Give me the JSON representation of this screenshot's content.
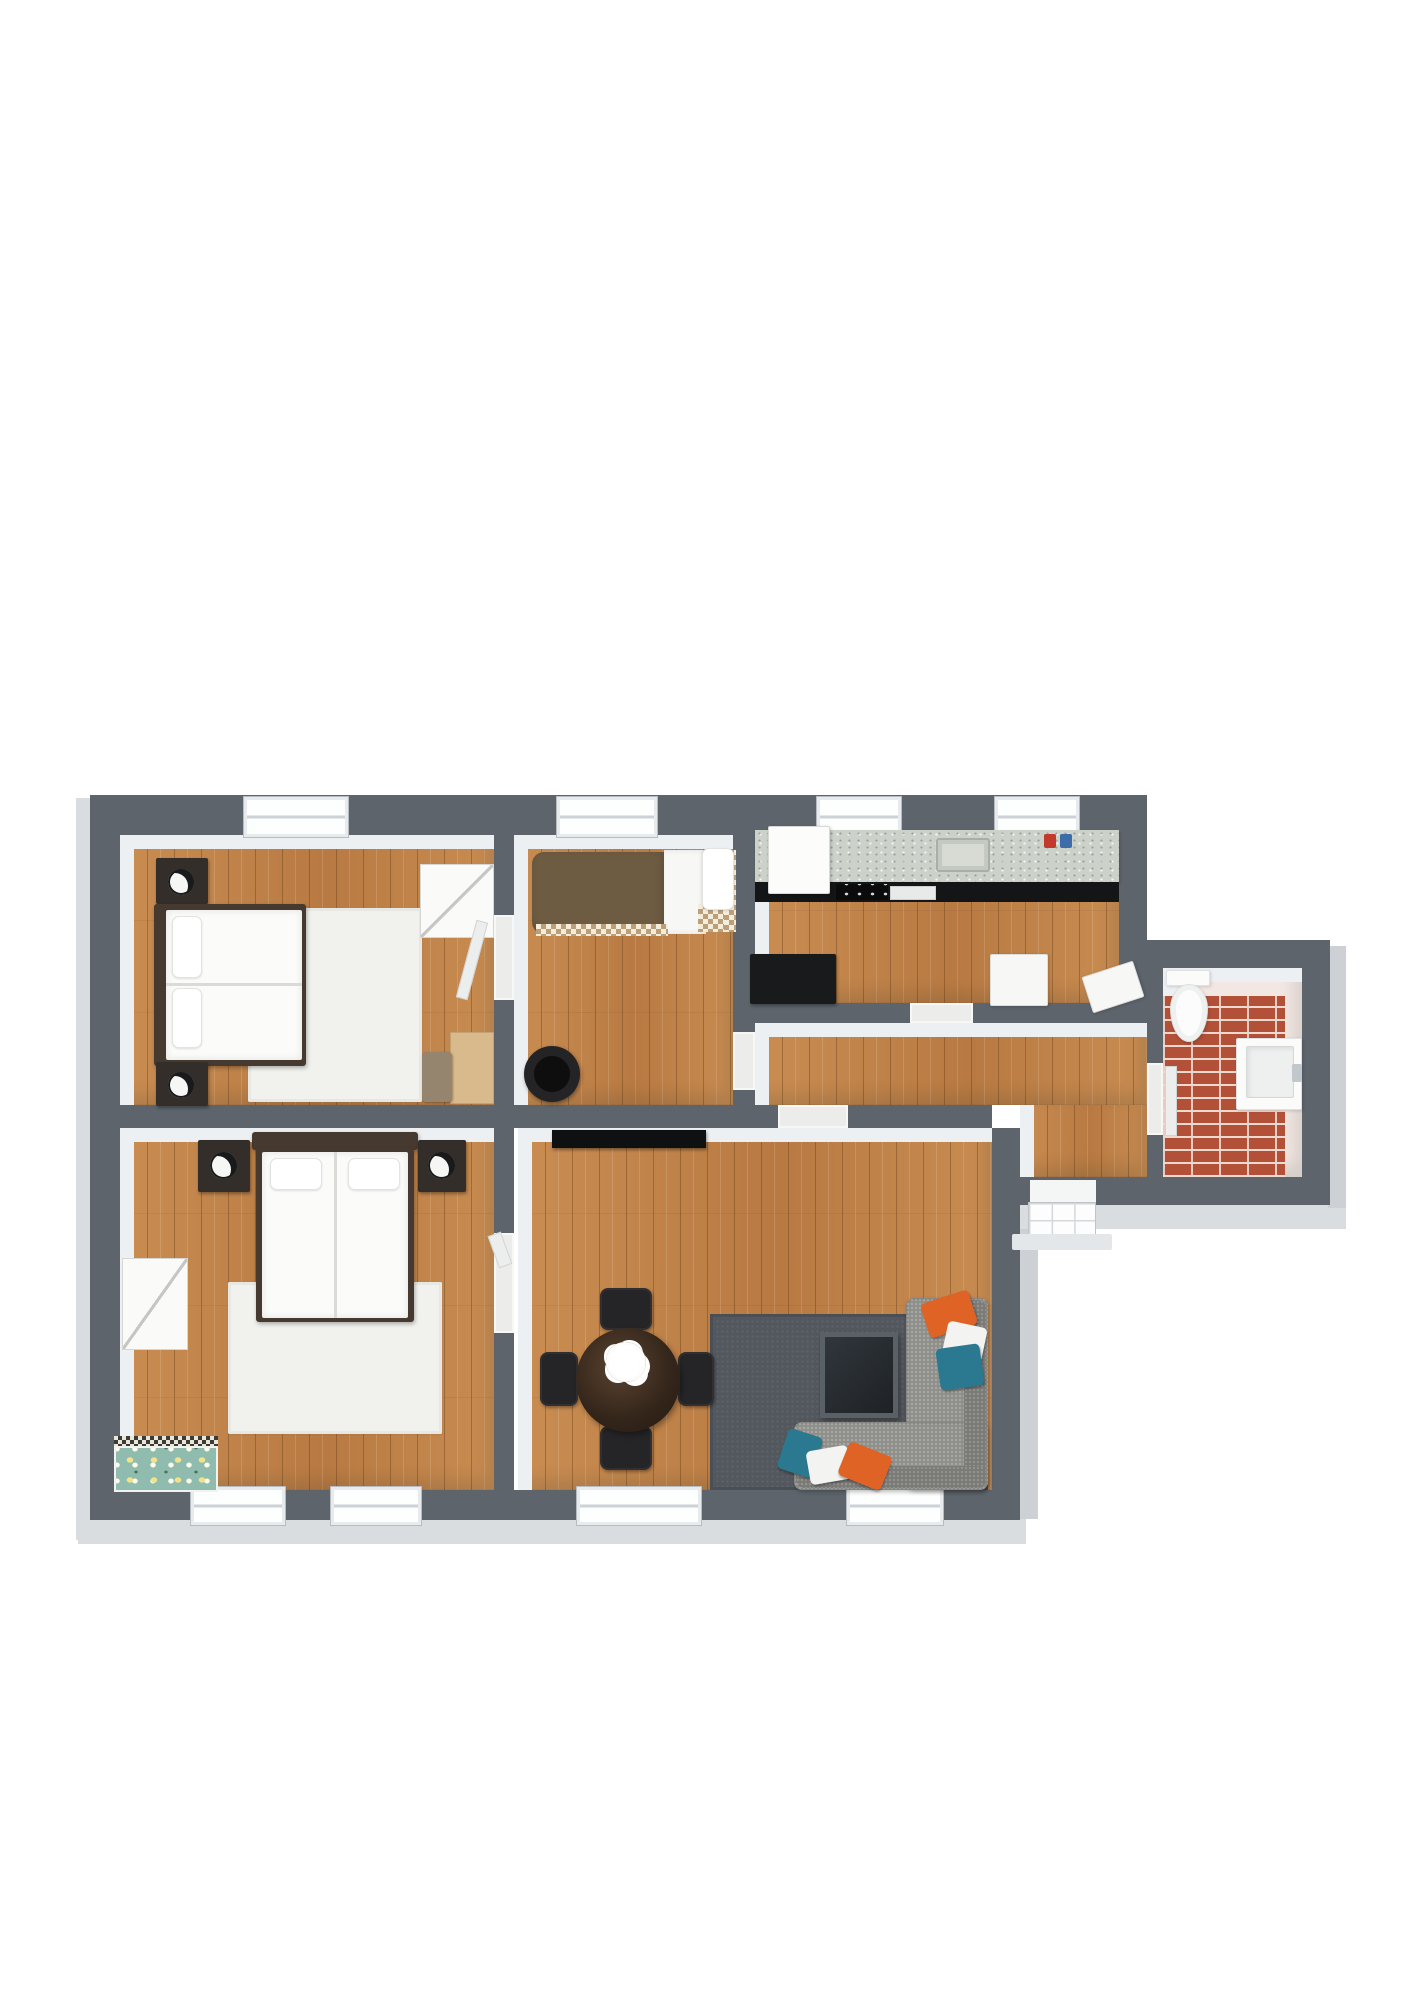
{
  "scene": {
    "width": 1413,
    "height": 2000,
    "background": "#ffffff",
    "description": "3D rendered apartment floor plan, top-down view, no text labels"
  },
  "palette": {
    "wall": "#5d646c",
    "wall_face": "#edf0f2",
    "wood": "#c28349",
    "wood_dark": "#b87a42",
    "rug_light": "#f1f1ee",
    "rug_dark": "#53585e",
    "sofa_gray": "#8e8e8b",
    "pillow_orange": "#e06326",
    "pillow_teal": "#2b7990",
    "brick_red": "#b35138",
    "counter_speckle": "#ccd1ca",
    "cabinet_black": "#141517",
    "jar_red": "#c23a2c",
    "jar_blue": "#3d6da8"
  },
  "layers": {
    "lips": [
      {
        "n": "outer-edge-left",
        "c": "lip",
        "x": 76,
        "y": 798,
        "w": 16,
        "h": 742
      },
      {
        "n": "outer-edge-bottom",
        "c": "lip",
        "x": 78,
        "y": 1516,
        "w": 948,
        "h": 28
      },
      {
        "n": "outer-edge-bottom-right",
        "c": "lip",
        "x": 1014,
        "y": 1205,
        "w": 332,
        "h": 24
      },
      {
        "n": "outer-edge-bath-right",
        "c": "lip2",
        "x": 1328,
        "y": 946,
        "w": 18,
        "h": 262
      },
      {
        "n": "outer-edge-living-right",
        "c": "lip2",
        "x": 1020,
        "y": 1229,
        "w": 18,
        "h": 290
      }
    ],
    "rooms": [
      {
        "n": "room-bedroom-1",
        "c": "wood faces-tl",
        "x": 120,
        "y": 835,
        "w": 374,
        "h": 270
      },
      {
        "n": "room-bedroom-middle",
        "c": "wood faces-tl",
        "x": 514,
        "y": 835,
        "w": 219,
        "h": 270
      },
      {
        "n": "room-kitchen",
        "c": "wood faces-tl",
        "x": 755,
        "y": 835,
        "w": 364,
        "h": 168
      },
      {
        "n": "room-hallway-upper",
        "c": "wood faces-tl",
        "x": 755,
        "y": 1023,
        "w": 392,
        "h": 82
      },
      {
        "n": "room-hallway-entry",
        "c": "wood faces-l",
        "x": 1020,
        "y": 1105,
        "w": 127,
        "h": 72
      },
      {
        "n": "room-living-dining",
        "c": "wood faces-tl",
        "x": 518,
        "y": 1128,
        "w": 474,
        "h": 362
      },
      {
        "n": "room-bedroom-2",
        "c": "wood faces-tl",
        "x": 120,
        "y": 1128,
        "w": 374,
        "h": 362
      },
      {
        "n": "room-bathroom",
        "c": "tile faces-tl",
        "x": 1163,
        "y": 968,
        "w": 139,
        "h": 209
      }
    ],
    "walls": [
      {
        "n": "wall-outer-top",
        "c": "wall",
        "x": 90,
        "y": 795,
        "w": 1057,
        "h": 40
      },
      {
        "n": "wall-outer-left",
        "c": "wall",
        "x": 90,
        "y": 795,
        "w": 30,
        "h": 725
      },
      {
        "n": "wall-outer-bottom",
        "c": "wall",
        "x": 90,
        "y": 1490,
        "w": 930,
        "h": 30
      },
      {
        "n": "wall-living-right",
        "c": "wall",
        "x": 992,
        "y": 1128,
        "w": 28,
        "h": 392
      },
      {
        "n": "wall-kitchen-right",
        "c": "wall",
        "x": 1119,
        "y": 795,
        "w": 28,
        "h": 208
      },
      {
        "n": "wall-bathroom-top",
        "c": "wall",
        "x": 1147,
        "y": 940,
        "w": 183,
        "h": 28
      },
      {
        "n": "wall-bathroom-right",
        "c": "wall",
        "x": 1302,
        "y": 940,
        "w": 28,
        "h": 265
      },
      {
        "n": "wall-bathroom-bottom",
        "c": "wall",
        "x": 1020,
        "y": 1177,
        "w": 310,
        "h": 28
      },
      {
        "n": "wall-divider-left",
        "c": "wall",
        "x": 120,
        "y": 1105,
        "w": 658,
        "h": 23
      },
      {
        "n": "wall-divider-right",
        "c": "wall",
        "x": 848,
        "y": 1105,
        "w": 144,
        "h": 23
      },
      {
        "n": "wall-bed1-middle-upper",
        "c": "wall",
        "x": 494,
        "y": 795,
        "w": 20,
        "h": 120
      },
      {
        "n": "wall-bed1-middle-lower",
        "c": "wall",
        "x": 494,
        "y": 1000,
        "w": 20,
        "h": 105
      },
      {
        "n": "wall-middle-kitchen",
        "c": "wall",
        "x": 733,
        "y": 795,
        "w": 22,
        "h": 237
      },
      {
        "n": "wall-middle-kitchen-stub",
        "c": "wall",
        "x": 733,
        "y": 1090,
        "w": 22,
        "h": 15
      },
      {
        "n": "wall-kitchen-bottom-left",
        "c": "wall",
        "x": 755,
        "y": 1003,
        "w": 155,
        "h": 20
      },
      {
        "n": "wall-kitchen-bottom-right",
        "c": "wall",
        "x": 973,
        "y": 1003,
        "w": 174,
        "h": 20
      },
      {
        "n": "wall-bed2-living-upper",
        "c": "wall",
        "x": 494,
        "y": 1128,
        "w": 20,
        "h": 105
      },
      {
        "n": "wall-bed2-living-lower",
        "c": "wall",
        "x": 494,
        "y": 1333,
        "w": 20,
        "h": 157
      },
      {
        "n": "wall-bathroom-door-upper",
        "c": "wall",
        "x": 1147,
        "y": 968,
        "w": 16,
        "h": 95
      },
      {
        "n": "wall-bathroom-door-lower",
        "c": "wall",
        "x": 1147,
        "y": 1135,
        "w": 16,
        "h": 42
      }
    ],
    "thresholds": [
      {
        "n": "door-bedroom1-middle",
        "c": "thr",
        "x": 494,
        "y": 915,
        "w": 20,
        "h": 85
      },
      {
        "n": "door-middle-hallway",
        "c": "thr",
        "x": 733,
        "y": 1032,
        "w": 22,
        "h": 58
      },
      {
        "n": "door-kitchen-hallway",
        "c": "thr",
        "x": 910,
        "y": 1003,
        "w": 63,
        "h": 20
      },
      {
        "n": "door-living-hallway",
        "c": "thr",
        "x": 778,
        "y": 1105,
        "w": 70,
        "h": 23
      },
      {
        "n": "door-bedroom2-living",
        "c": "thr",
        "x": 494,
        "y": 1233,
        "w": 20,
        "h": 100
      },
      {
        "n": "door-bathroom",
        "c": "thr",
        "x": 1147,
        "y": 1063,
        "w": 16,
        "h": 72
      }
    ],
    "windows": [
      {
        "n": "window-bedroom1",
        "c": "window",
        "x": 243,
        "y": 796,
        "w": 106,
        "h": 42
      },
      {
        "n": "window-middle-room",
        "c": "window",
        "x": 556,
        "y": 796,
        "w": 102,
        "h": 42
      },
      {
        "n": "window-kitchen-1",
        "c": "window",
        "x": 816,
        "y": 796,
        "w": 86,
        "h": 42
      },
      {
        "n": "window-kitchen-2",
        "c": "window",
        "x": 994,
        "y": 796,
        "w": 86,
        "h": 42
      },
      {
        "n": "window-bedroom2-1",
        "c": "window",
        "x": 190,
        "y": 1486,
        "w": 96,
        "h": 40
      },
      {
        "n": "window-bedroom2-2",
        "c": "window",
        "x": 330,
        "y": 1486,
        "w": 92,
        "h": 40
      },
      {
        "n": "window-living-1",
        "c": "window",
        "x": 576,
        "y": 1486,
        "w": 126,
        "h": 40
      },
      {
        "n": "window-living-2",
        "c": "window",
        "x": 846,
        "y": 1486,
        "w": 98,
        "h": 40
      }
    ],
    "furniture": [
      {
        "n": "bedroom1-rug",
        "c": "rug-light",
        "x": 248,
        "y": 908,
        "w": 174,
        "h": 194
      },
      {
        "n": "bedroom1-nightstand-top",
        "c": "nightstand",
        "x": 156,
        "y": 858,
        "w": 52,
        "h": 46
      },
      {
        "n": "bedroom1-lamp-top",
        "c": "lamp",
        "x": 168,
        "y": 869,
        "w": 26,
        "h": 26
      },
      {
        "n": "bedroom1-bed-frame",
        "c": "bedframe",
        "x": 154,
        "y": 904,
        "w": 152,
        "h": 162
      },
      {
        "n": "bedroom1-bed-mattress",
        "c": "mattress",
        "x": 166,
        "y": 910,
        "w": 136,
        "h": 150
      },
      {
        "n": "bedroom1-bed-seam",
        "c": "seam",
        "x": 166,
        "y": 983,
        "w": 136,
        "h": 3
      },
      {
        "n": "bedroom1-pillow-1",
        "c": "pillow",
        "x": 172,
        "y": 916,
        "w": 30,
        "h": 62
      },
      {
        "n": "bedroom1-pillow-2",
        "c": "pillow",
        "x": 172,
        "y": 988,
        "w": 30,
        "h": 60
      },
      {
        "n": "bedroom1-nightstand-bottom",
        "c": "nightstand",
        "x": 156,
        "y": 1062,
        "w": 52,
        "h": 44
      },
      {
        "n": "bedroom1-lamp-bottom",
        "c": "lamp",
        "x": 168,
        "y": 1072,
        "w": 26,
        "h": 26
      },
      {
        "n": "bedroom1-wardrobe",
        "c": "white-case",
        "x": 420,
        "y": 864,
        "w": 74,
        "h": 74
      },
      {
        "n": "bedroom1-desk",
        "c": "desk",
        "x": 450,
        "y": 1032,
        "w": 44,
        "h": 72
      },
      {
        "n": "bedroom1-desk-chair",
        "c": "chair-tan",
        "x": 422,
        "y": 1052,
        "w": 30,
        "h": 50
      },
      {
        "n": "bedroom1-door-leaf",
        "c": "leaf",
        "x": 466,
        "y": 920,
        "w": 12,
        "h": 80,
        "r": 15
      },
      {
        "n": "middle-bed-duvet",
        "c": "duvet",
        "x": 532,
        "y": 852,
        "w": 136,
        "h": 82
      },
      {
        "n": "middle-bed-sheet",
        "c": "sheet",
        "x": 664,
        "y": 850,
        "w": 42,
        "h": 84
      },
      {
        "n": "middle-bed-checker-strip",
        "c": "checker",
        "x": 536,
        "y": 924,
        "w": 132,
        "h": 12
      },
      {
        "n": "middle-bed-checker-corner",
        "c": "checker",
        "x": 698,
        "y": 904,
        "w": 38,
        "h": 28
      },
      {
        "n": "middle-bed-checker-right",
        "c": "checker",
        "x": 724,
        "y": 850,
        "w": 12,
        "h": 82
      },
      {
        "n": "middle-bed-pillow",
        "c": "pillow",
        "x": 702,
        "y": 848,
        "w": 32,
        "h": 62
      },
      {
        "n": "middle-tub-chair",
        "c": "tubchair",
        "x": 524,
        "y": 1046,
        "w": 56,
        "h": 56
      },
      {
        "n": "middle-tub-chair-seat",
        "c": "tubchair-in",
        "x": 534,
        "y": 1056,
        "w": 36,
        "h": 36
      },
      {
        "n": "kitchen-counter",
        "c": "counter",
        "x": 755,
        "y": 830,
        "w": 364,
        "h": 52
      },
      {
        "n": "kitchen-cabinets",
        "c": "cabinets",
        "x": 755,
        "y": 882,
        "w": 364,
        "h": 20
      },
      {
        "n": "kitchen-fridge",
        "c": "appliance-white",
        "x": 768,
        "y": 826,
        "w": 62,
        "h": 68
      },
      {
        "n": "kitchen-stove",
        "c": "stove",
        "x": 836,
        "y": 884,
        "w": 52,
        "h": 16
      },
      {
        "n": "kitchen-dishwasher",
        "c": "dishwasher",
        "x": 890,
        "y": 886,
        "w": 46,
        "h": 14
      },
      {
        "n": "kitchen-sink",
        "c": "sink",
        "x": 936,
        "y": 838,
        "w": 54,
        "h": 34
      },
      {
        "n": "kitchen-jar-red",
        "c": "jar-red",
        "x": 1044,
        "y": 834,
        "w": 12,
        "h": 14
      },
      {
        "n": "kitchen-jar-blue",
        "c": "jar-blue",
        "x": 1060,
        "y": 834,
        "w": 12,
        "h": 14
      },
      {
        "n": "kitchen-table-black",
        "c": "table-black",
        "x": 750,
        "y": 954,
        "w": 86,
        "h": 50
      },
      {
        "n": "kitchen-table-white",
        "c": "table-white",
        "x": 990,
        "y": 954,
        "w": 58,
        "h": 52
      },
      {
        "n": "kitchen-chair-white",
        "c": "table-white",
        "x": 1086,
        "y": 968,
        "w": 54,
        "h": 38,
        "r": -18
      },
      {
        "n": "bathroom-brick-floor",
        "c": "brick",
        "x": 1163,
        "y": 996,
        "w": 122,
        "h": 181
      },
      {
        "n": "bathroom-door-leaf",
        "c": "leaf",
        "x": 1165,
        "y": 1066,
        "w": 12,
        "h": 70
      },
      {
        "n": "toilet-tank",
        "c": "porcelain",
        "x": 1166,
        "y": 970,
        "w": 44,
        "h": 16
      },
      {
        "n": "toilet-bowl",
        "c": "bowl",
        "x": 1170,
        "y": 984,
        "w": 38,
        "h": 58
      },
      {
        "n": "bathroom-vanity",
        "c": "porcelain",
        "x": 1236,
        "y": 1038,
        "w": 66,
        "h": 72
      },
      {
        "n": "bathroom-basin",
        "c": "basin",
        "x": 1246,
        "y": 1046,
        "w": 48,
        "h": 52
      },
      {
        "n": "bathroom-faucet",
        "c": "faucet",
        "x": 1292,
        "y": 1064,
        "w": 10,
        "h": 18
      },
      {
        "n": "living-console",
        "c": "console",
        "x": 552,
        "y": 1130,
        "w": 154,
        "h": 18
      },
      {
        "n": "living-rug",
        "c": "rug-dark",
        "x": 710,
        "y": 1314,
        "w": 278,
        "h": 176
      },
      {
        "n": "living-tv-panel",
        "c": "tv",
        "x": 820,
        "y": 1332,
        "w": 78,
        "h": 86
      },
      {
        "n": "sofa-right-section",
        "c": "sofa",
        "x": 906,
        "y": 1298,
        "w": 82,
        "h": 192
      },
      {
        "n": "sofa-bottom-section",
        "c": "sofa",
        "x": 794,
        "y": 1422,
        "w": 194,
        "h": 68
      },
      {
        "n": "sofa-backrest-right",
        "c": "sofa-back",
        "x": 964,
        "y": 1300,
        "w": 22,
        "h": 188
      },
      {
        "n": "sofa-backrest-bottom",
        "c": "sofa-back",
        "x": 796,
        "y": 1466,
        "w": 190,
        "h": 22
      },
      {
        "n": "sofa-pillow-orange-top",
        "c": "pillow-o",
        "x": 924,
        "y": 1296,
        "w": 50,
        "h": 36,
        "r": -18
      },
      {
        "n": "sofa-pillow-white-top",
        "c": "pillow-w",
        "x": 944,
        "y": 1324,
        "w": 40,
        "h": 42,
        "r": 12
      },
      {
        "n": "sofa-pillow-teal-top",
        "c": "pillow-t",
        "x": 938,
        "y": 1346,
        "w": 44,
        "h": 42,
        "r": -8
      },
      {
        "n": "sofa-pillow-teal-bottom",
        "c": "pillow-t",
        "x": 782,
        "y": 1432,
        "w": 36,
        "h": 42,
        "r": 18
      },
      {
        "n": "sofa-pillow-white-bottom",
        "c": "pillow-w",
        "x": 808,
        "y": 1448,
        "w": 42,
        "h": 34,
        "r": -10
      },
      {
        "n": "sofa-pillow-orange-bottom",
        "c": "pillow-o",
        "x": 842,
        "y": 1448,
        "w": 46,
        "h": 36,
        "r": 22
      },
      {
        "n": "dining-chair-top",
        "c": "chair-dark",
        "x": 600,
        "y": 1288,
        "w": 52,
        "h": 42
      },
      {
        "n": "dining-chair-bottom",
        "c": "chair-dark",
        "x": 600,
        "y": 1426,
        "w": 52,
        "h": 44
      },
      {
        "n": "dining-chair-left",
        "c": "chair-dark",
        "x": 540,
        "y": 1352,
        "w": 38,
        "h": 54
      },
      {
        "n": "dining-chair-right",
        "c": "chair-dark",
        "x": 678,
        "y": 1352,
        "w": 36,
        "h": 54
      },
      {
        "n": "dining-table",
        "c": "table-round",
        "x": 576,
        "y": 1328,
        "w": 104,
        "h": 104
      },
      {
        "n": "dining-table-flowers",
        "c": "flower",
        "x": 606,
        "y": 1342,
        "w": 40,
        "h": 40
      },
      {
        "n": "bedroom2-rug",
        "c": "rug-light",
        "x": 228,
        "y": 1282,
        "w": 214,
        "h": 152
      },
      {
        "n": "bedroom2-headboard",
        "c": "bedframe",
        "x": 252,
        "y": 1132,
        "w": 166,
        "h": 18
      },
      {
        "n": "bedroom2-bed-frame",
        "c": "bedframe",
        "x": 256,
        "y": 1148,
        "w": 158,
        "h": 174
      },
      {
        "n": "bedroom2-bed-mattress",
        "c": "mattress",
        "x": 262,
        "y": 1152,
        "w": 146,
        "h": 166
      },
      {
        "n": "bedroom2-bed-seam",
        "c": "seam",
        "x": 334,
        "y": 1152,
        "w": 3,
        "h": 166
      },
      {
        "n": "bedroom2-pillow-1",
        "c": "pillow",
        "x": 270,
        "y": 1158,
        "w": 52,
        "h": 32
      },
      {
        "n": "bedroom2-pillow-2",
        "c": "pillow",
        "x": 348,
        "y": 1158,
        "w": 52,
        "h": 32
      },
      {
        "n": "bedroom2-nightstand-left",
        "c": "nightstand",
        "x": 198,
        "y": 1140,
        "w": 52,
        "h": 52
      },
      {
        "n": "bedroom2-lamp-left",
        "c": "lamp",
        "x": 210,
        "y": 1152,
        "w": 27,
        "h": 27
      },
      {
        "n": "bedroom2-nightstand-right",
        "c": "nightstand",
        "x": 418,
        "y": 1140,
        "w": 48,
        "h": 52
      },
      {
        "n": "bedroom2-lamp-right",
        "c": "lamp",
        "x": 428,
        "y": 1152,
        "w": 27,
        "h": 27
      },
      {
        "n": "bedroom2-dresser",
        "c": "white-case",
        "x": 122,
        "y": 1258,
        "w": 66,
        "h": 92
      },
      {
        "n": "bedroom2-bench-edge",
        "c": "bench-edge",
        "x": 114,
        "y": 1436,
        "w": 104,
        "h": 10
      },
      {
        "n": "bedroom2-floral-bench",
        "c": "bench",
        "x": 114,
        "y": 1446,
        "w": 104,
        "h": 46
      },
      {
        "n": "bedroom2-door-leaf",
        "c": "leaf",
        "x": 493,
        "y": 1233,
        "w": 14,
        "h": 34,
        "r": -20
      },
      {
        "n": "entry-door-frame",
        "c": "entry-frame",
        "x": 1030,
        "y": 1180,
        "w": 66,
        "h": 24
      },
      {
        "n": "entry-door-leaf",
        "c": "entry-leaf",
        "x": 1028,
        "y": 1202,
        "w": 68,
        "h": 34
      },
      {
        "n": "entry-step",
        "c": "entry-step",
        "x": 1012,
        "y": 1234,
        "w": 100,
        "h": 16
      }
    ]
  }
}
